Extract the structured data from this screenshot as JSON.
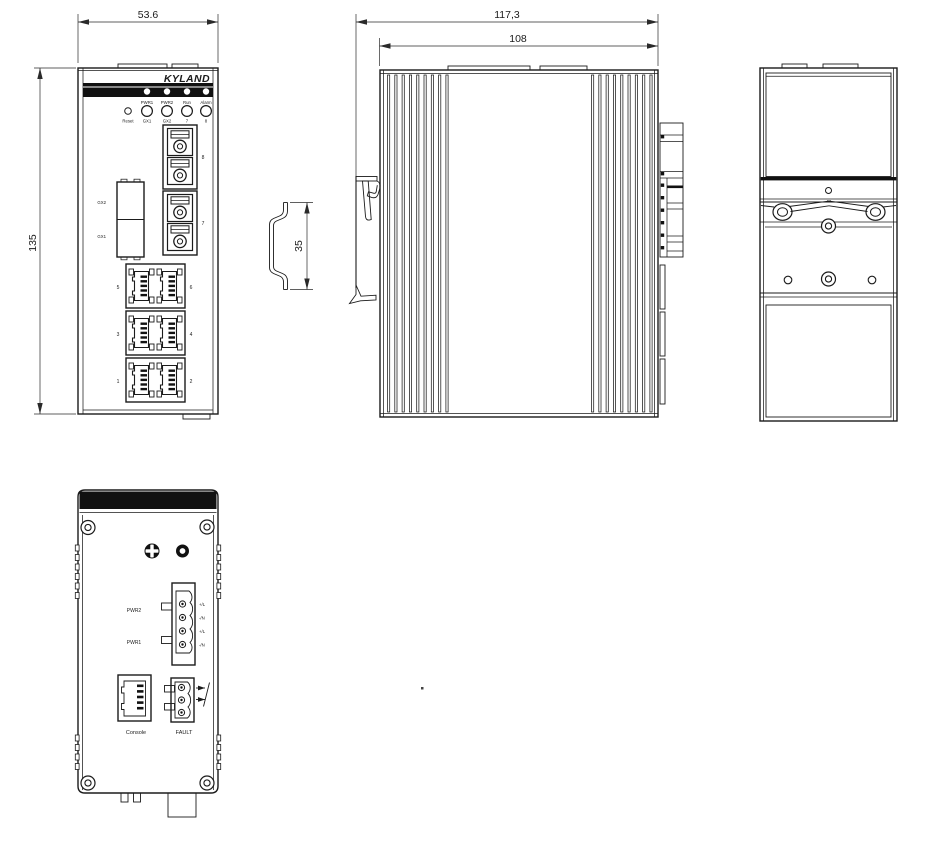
{
  "drawing": {
    "front": {
      "dim_width": "53.6",
      "dim_height": "135",
      "brand": "KYLAND",
      "led_top": [
        "PWR1",
        "PWR2",
        "Run",
        "Alarm"
      ],
      "reset": "Reset",
      "led_bottom": [
        "GX1",
        "GX2",
        "7",
        "8"
      ],
      "gx_slots": [
        "GX2",
        "GX1"
      ],
      "fiber_ports": [
        "8",
        "7"
      ],
      "rj45_ports": [
        [
          "5",
          "6"
        ],
        [
          "3",
          "4"
        ],
        [
          "1",
          "2"
        ]
      ]
    },
    "rail": {
      "dim_height": "35"
    },
    "side": {
      "dim_overall": "117,3",
      "dim_body": "108"
    },
    "bottom": {
      "power_rows": [
        "PWR2",
        "PWR1"
      ],
      "pins": [
        "+/L",
        "-/N",
        "+/L",
        "-/N"
      ],
      "console": "Console",
      "fault": "FAULT"
    },
    "colors": {
      "line": "#1b1b1b",
      "fill_dark": "#111111",
      "bg": "#ffffff"
    }
  }
}
